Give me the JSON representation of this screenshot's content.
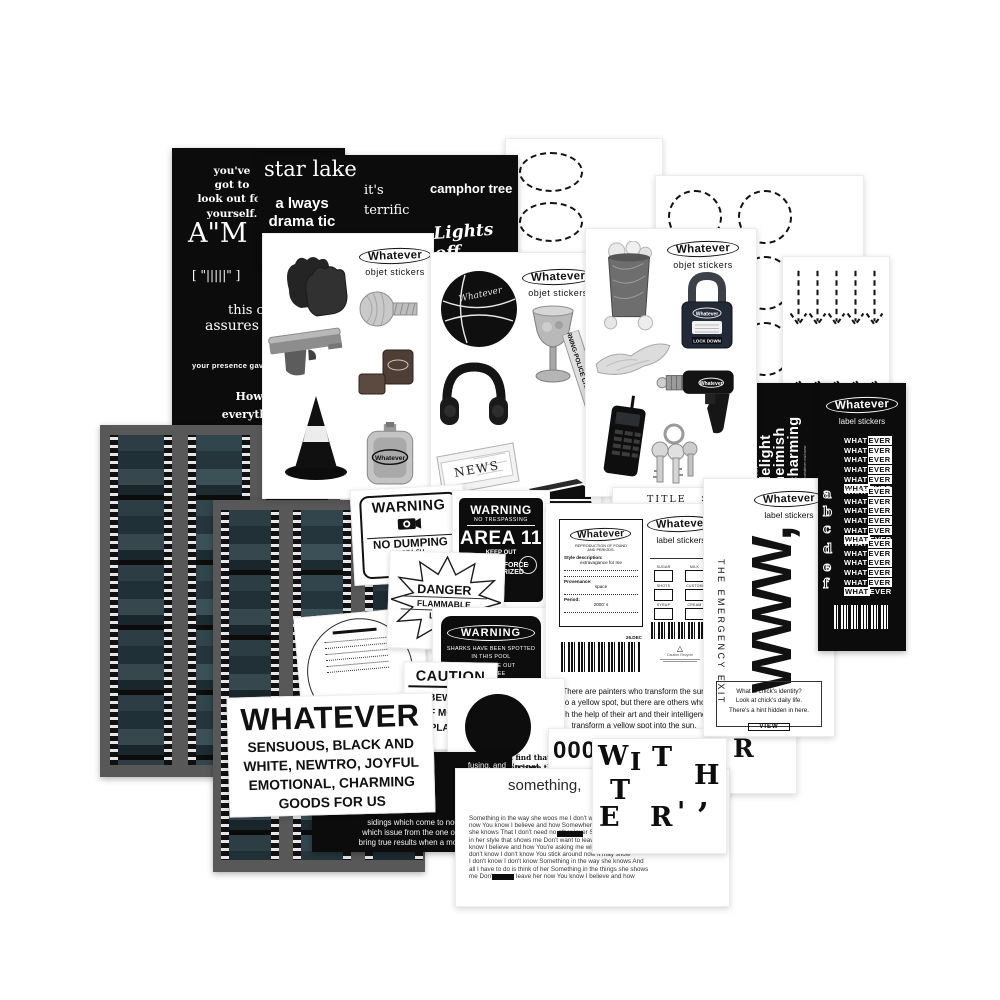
{
  "colors": {
    "paper": "#ffffff",
    "sheet_black": "#0c0c0c",
    "film_frame": "#2c3e44"
  },
  "sheetA": {
    "q1": "you've\ngot to\nlook out for\nyourself.",
    "q2": "A\"M",
    "q3": "[ \"|||||\" ]",
    "q4": "this c",
    "q5": "assures you",
    "q6": "your presence gave",
    "q7": "How my\neverything a"
  },
  "sheetB": {
    "q1": "star lake",
    "q2": "a lways\ndrama tic",
    "q3": "it's\nterrific",
    "q4": "camphor tree",
    "q5": "Lights off"
  },
  "objet": {
    "logo": "Whatever",
    "subtitle": "objet stickers",
    "basketball_text": "Whatever",
    "flask_text": "Whatever",
    "drill_text": "Whatever",
    "padlock_text": "Whatever",
    "padlock_bar": "LOCK DOWN",
    "tape_text": "WARNING·POLICE CRIME SCENE·DO",
    "news_text": "NEWS"
  },
  "labels_black": {
    "logo": "Whatever",
    "subtitle": "label stickers",
    "word_left": "WHAT",
    "word_right": "EVER",
    "letters": [
      "a",
      "b",
      "c",
      "d",
      "e",
      "f"
    ],
    "vertical_small": "from a to z",
    "vertical_big": "delight\nheimish\ncharming",
    "vertical_url": "www.whatever.mail.www"
  },
  "label_sheet": {
    "logo": "Whatever",
    "subtitle": "label stickers",
    "card": {
      "logo": "Whatever",
      "line1": "REPRODUCTION OF FOUND",
      "line2": "AND PERIODS.",
      "style_label": "Style description:",
      "style_value": "extravagance for me",
      "prov_label": "Provenance:",
      "prov_value": "space",
      "period_label": "Period:",
      "period_value": "2000' s"
    },
    "checkboxes": [
      "SUGAR",
      "MILK",
      "SHOTS",
      "CUSTOM",
      "SYRUP",
      "CREAM"
    ],
    "date": "26.DEC",
    "recycle_symbol": "△",
    "recycle_note": "Caution  Recycle",
    "quote": "There are painters who transform the sun\nto a yellow spot, but there are others who\nwith the help of their art and their intelligence,\ntransform a yellow spot into the sun."
  },
  "title_sheet": {
    "title": "TITLE",
    "marks": "✕ ✕",
    "marks2": "✕ ✕",
    "rows": [
      "fe",
      "ue",
      "H"
    ]
  },
  "www_sheet": {
    "logo": "Whatever",
    "subtitle": "label stickers",
    "big": "WWW,",
    "vertical": "THE EMERGENCY EXIT",
    "box_line1": "What is chick's identity?",
    "box_line2": "Look at chick's daily life.",
    "box_line3": "There's a hint hidden in here.",
    "button": "VIEW"
  },
  "warnings": {
    "dump": {
      "title": "WARNING",
      "name": "NO DUMPING",
      "sub1": "AREA SU",
      "sub2": "(VIOLAT"
    },
    "area": {
      "title": "WARNING",
      "sub": "NO TRESPASSING",
      "big": "AREA 11",
      "keep": "KEEP OUT",
      "l1": "DEADLY FORCE",
      "l2": "AUTHORIZED"
    },
    "danger": {
      "title": "DANGER",
      "l1": "FLAMMABLE",
      "l2": "LIQUID"
    },
    "shark": {
      "title": "WARNING",
      "lines": "SHARKS HAVE BEEN SPOTTED\nIN THIS POOL\nTHEY COME OUT\nSTILL PEE"
    },
    "caution": {
      "title": "CAUTION",
      "lines": "BEWARE\nOF MOVING\nPLANTS"
    }
  },
  "circle_sheet": {
    "l1": "If you find that you're not,",
    "l2": "hope you have the strength"
  },
  "horn_sheet": {
    "lines": [
      "fusing, and",
      "t to pass",
      "s have two",
      "and",
      "through the",
      ", bringing",
      "sidings which come to nought, but those",
      "which issue from the one of polished horn",
      "bring true results when a mortal sees them"
    ]
  },
  "whatever_sticker": {
    "title": "WHATEVER",
    "lines": "SENSUOUS, BLACK AND\nWHITE, NEWTRO, JOYFUL\nEMOTIONAL, CHARMING\nGOODS FOR US"
  },
  "phone_sheet": {
    "left": "000-0",
    "right": "R"
  },
  "something_sheet": {
    "title": "something,",
    "lyrics": [
      "Something in the way she woos me I don't want to lea",
      "now You know I believe and how Somewhere in her s",
      "she knows That I don't need no other lover Somethin",
      "in her style that shows me Don't want to leave her no",
      "know I believe and how You're asking me will my love",
      "don't know I don't know You stick around now it may show",
      "I don't know I don't know Something in the way she knows And",
      "all I have to do is think of her Something in the things she shows",
      "me Don't wanna leave her now You know I believe and how"
    ]
  },
  "letters_sheet": {
    "letters": [
      "W",
      "I",
      "T",
      "H",
      "T",
      ",",
      "E",
      "R",
      "'"
    ]
  },
  "counts": {
    "ovals": 6,
    "circles": 9,
    "arrows_down": 5,
    "arrows_up": 5,
    "wlines": 6
  }
}
